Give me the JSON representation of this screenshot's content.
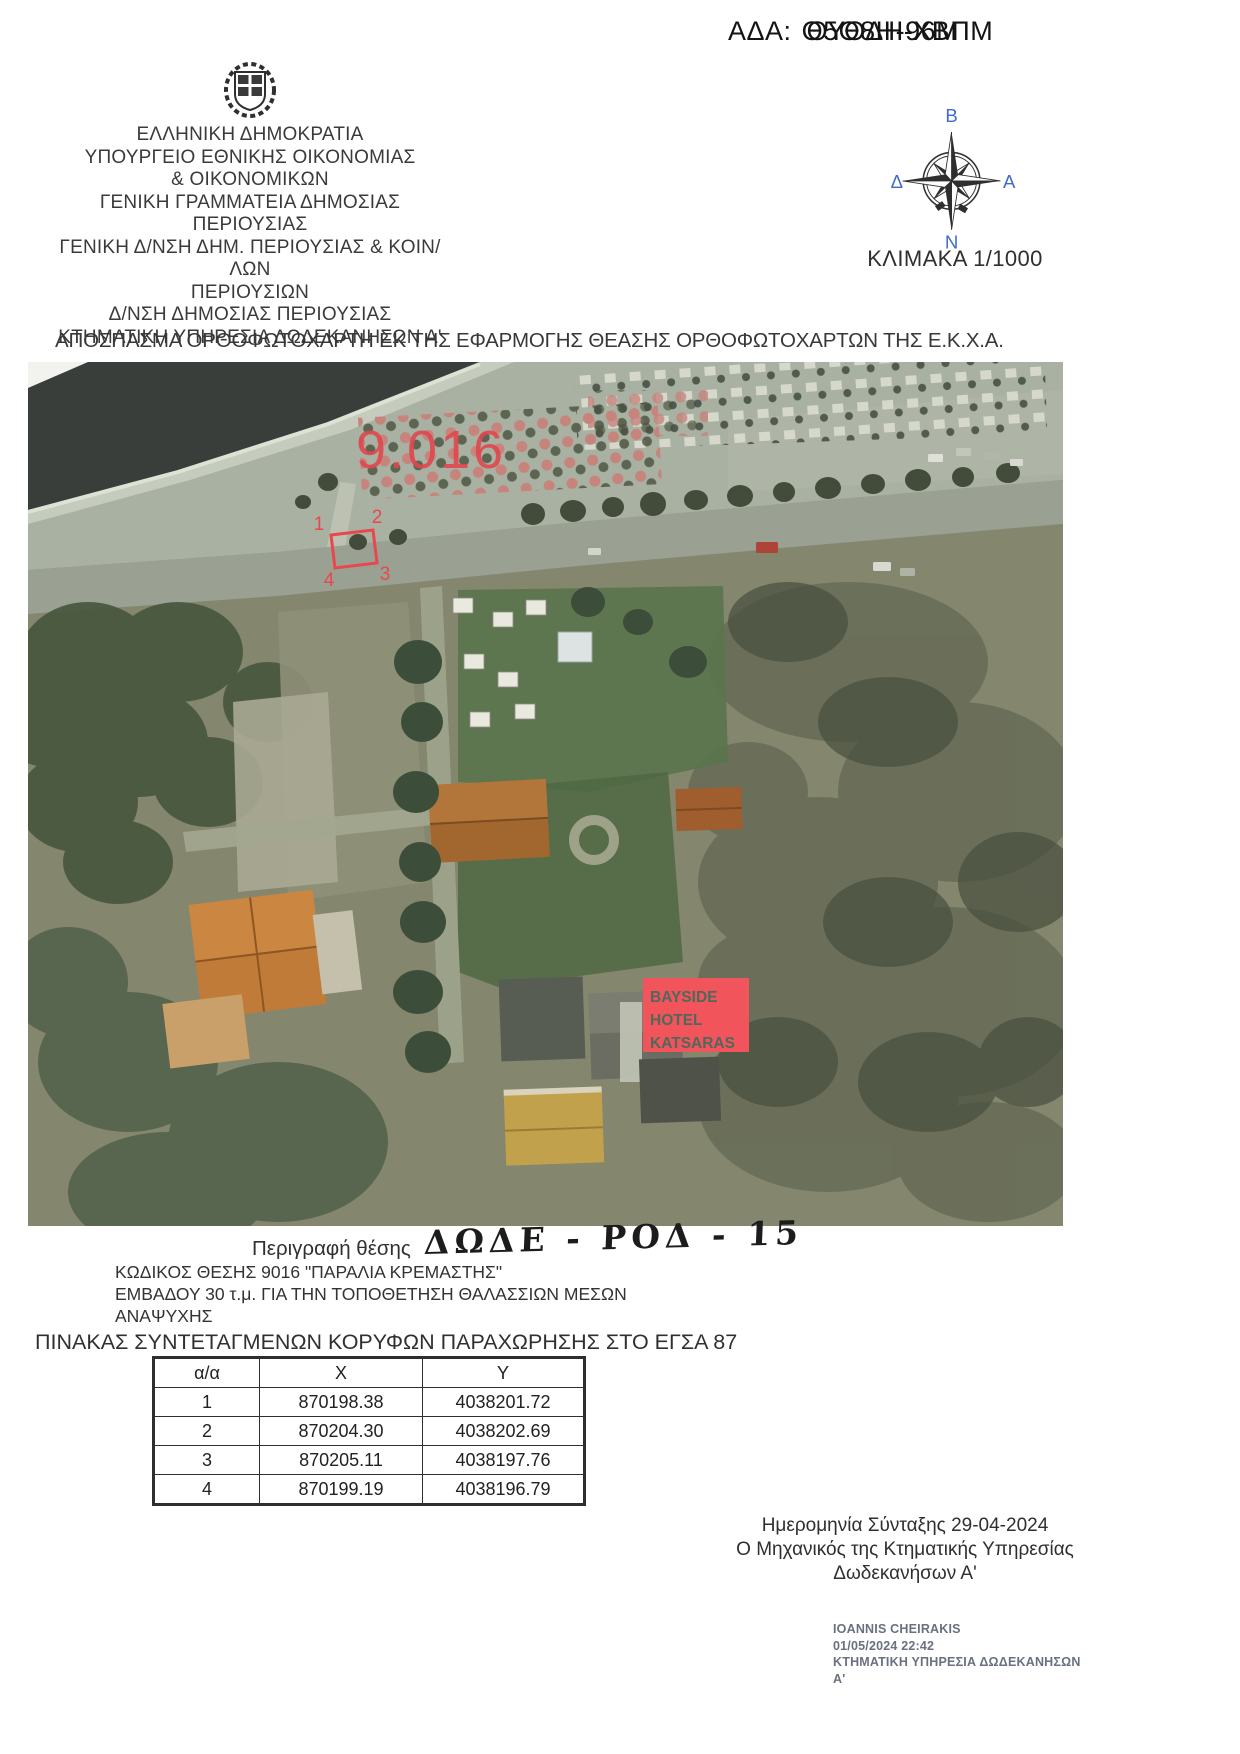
{
  "ada": {
    "prefix": "ΑΔΑ:",
    "code_layer1": "Θ5Θ8Η-96Μ",
    "code_layer2": "ΘΥΘΔΗ-ΧΒΠΜ"
  },
  "header": {
    "lines": [
      "ΕΛΛΗΝΙΚΗ ΔΗΜΟΚΡΑΤΙΑ",
      "ΥΠΟΥΡΓΕΙΟ ΕΘΝΙΚΗΣ ΟΙΚΟΝΟΜΙΑΣ",
      "& ΟΙΚΟΝΟΜΙΚΩΝ",
      "ΓΕΝΙΚΗ ΓΡΑΜΜΑΤΕΙΑ ΔΗΜΟΣΙΑΣ ΠΕΡΙΟΥΣΙΑΣ",
      "ΓΕΝΙΚΗ Δ/ΝΣΗ ΔΗΜ. ΠΕΡΙΟΥΣΙΑΣ & ΚΟΙΝ/ΛΩΝ",
      "ΠΕΡΙΟΥΣΙΩΝ",
      "Δ/ΝΣΗ ΔΗΜΟΣΙΑΣ ΠΕΡΙΟΥΣΙΑΣ",
      "ΚΤΗΜΑΤΙΚΗ ΥΠΗΡΕΣΙΑ ΔΩΔΕΚΑΝΗΣΩΝ Α'"
    ]
  },
  "compass": {
    "north": "Β",
    "south": "Ν",
    "east": "Α",
    "west": "Δ"
  },
  "scale_label": "ΚΛΙΜΑΚΑ 1/1000",
  "map_title": "ΑΠΟΣΠΑΣΜΑ ΟΡΘΟΦΩΤΟΧΑΡΤΗ ΕΚ ΤΗΣ ΕΦΑΡΜΟΓΗΣ ΘΕΑΣΗΣ ΟΡΘΟΦΩΤΟΧΑΡΤΩΝ ΤΗΣ Ε.Κ.Χ.Α.",
  "map": {
    "area_label": "9.016",
    "parcel_vertices": [
      "1",
      "2",
      "3",
      "4"
    ],
    "hotel_label_lines": [
      "BAYSIDE",
      "HOTEL",
      "KATSARAS"
    ]
  },
  "location": {
    "description_label": "Περιγραφή θέσης",
    "description_value": "ΔΩΔΕ - ΡΟΔ - 15",
    "code_line": "ΚΩΔΙΚΟΣ ΘΕΣΗΣ 9016 \"ΠΑΡΑΛΙΑ ΚΡΕΜΑΣΤΗΣ\"",
    "area_line1": "ΕΜΒΑΔΟΥ 30 τ.μ. ΓΙΑ ΤΗΝ ΤΟΠΟΘΕΤΗΣΗ ΘΑΛΑΣΣΙΩΝ ΜΕΣΩΝ",
    "area_line2": "ΑΝΑΨΥΧΗΣ",
    "table_title": "ΠΙΝΑΚΑΣ ΣΥΝΤΕΤΑΓΜΕΝΩΝ ΚΟΡΥΦΩΝ ΠΑΡΑΧΩΡΗΣΗΣ ΣΤΟ ΕΓΣΑ 87"
  },
  "coords_table": {
    "headers": [
      "α/α",
      "X",
      "Y"
    ],
    "rows": [
      [
        "1",
        "870198.38",
        "4038201.72"
      ],
      [
        "2",
        "870204.30",
        "4038202.69"
      ],
      [
        "3",
        "870205.11",
        "4038197.76"
      ],
      [
        "4",
        "870199.19",
        "4038196.79"
      ]
    ]
  },
  "footer": {
    "date_line": "Ημερομηνία Σύνταξης 29-04-2024",
    "engineer_line1": "Ο Μηχανικός της Κτηματικής Υπηρεσίας",
    "engineer_line2": "Δωδεκανήσων Α'",
    "signature": {
      "name": "IOANNIS CHEIRAKIS",
      "datetime": "01/05/2024 22:42",
      "org_line1": "ΚΤΗΜΑΤΙΚΗ ΥΠΗΡΕΣΙΑ ΔΩΔΕΚΑΝΗΣΩΝ",
      "org_line2": "Α'"
    }
  },
  "colors": {
    "annotation_red": "#e8474d",
    "hotel_box_red": "#f2545c",
    "compass_blue": "#3f6cc8",
    "signature_gray": "#697080"
  }
}
